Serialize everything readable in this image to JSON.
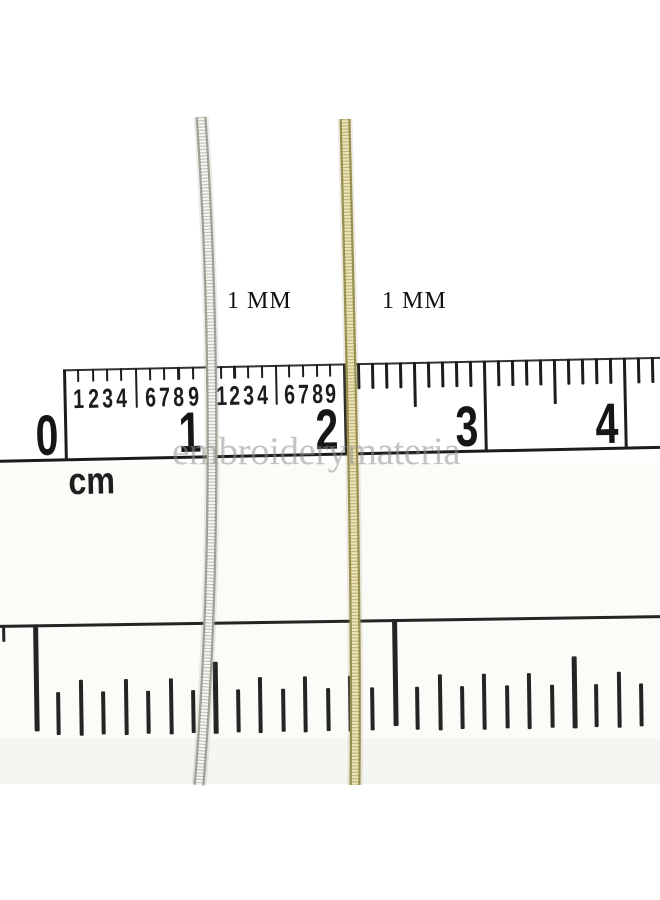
{
  "photo": {
    "background": "#ffffff",
    "bands": [
      {
        "name": "mid-tone-band",
        "top": 463,
        "height": 275,
        "color": "#fbfbf8"
      },
      {
        "name": "lower-tone-band",
        "top": 738,
        "height": 46,
        "color": "#f5f5f1"
      }
    ],
    "watermark": {
      "text": "embroiderymateria",
      "x": 172,
      "y": 429,
      "color": "#8f8f8f"
    },
    "size_labels": [
      {
        "text": "1 MM",
        "x": 227,
        "y": 288
      },
      {
        "text": "1 MM",
        "x": 382,
        "y": 288
      }
    ]
  },
  "top_ruler": {
    "unit_label": "cm",
    "ink": "#1c1c1c",
    "tilt_deg": -1.2,
    "origin": {
      "left": -15,
      "top": 371,
      "width": 700,
      "height": 140
    },
    "baseline_y": 89,
    "cm_marks": [
      {
        "label": "0",
        "x": 78
      },
      {
        "label": "1",
        "x": 221
      },
      {
        "label": "2",
        "x": 358
      },
      {
        "label": "3",
        "x": 498
      },
      {
        "label": "4",
        "x": 638
      }
    ],
    "mm_digit_run": [
      "1",
      "2",
      "3",
      "4",
      "6",
      "7",
      "8",
      "9"
    ],
    "digit_sections": [
      0,
      1
    ],
    "plain_sections": [
      2,
      3,
      4
    ],
    "tick_style": {
      "fine": {
        "len": 13,
        "long5": 40,
        "w": 2.2
      },
      "plain": {
        "len": 26,
        "long5": 45,
        "w": 3.4
      }
    }
  },
  "bottom_ruler": {
    "ink": "#242424",
    "tilt_deg": -0.85,
    "origin": {
      "left": -5,
      "top": 619,
      "width": 700,
      "height": 170
    },
    "topline_y": 6,
    "end_stub_x": 7,
    "ticks": {
      "major_x": [
        38,
        397
      ],
      "half_x": [
        217,
        576
      ],
      "eighth_x": [
        83,
        128,
        173,
        262,
        307,
        352,
        442,
        486,
        531,
        621,
        665
      ],
      "sixteenth_x": [
        60,
        105,
        150,
        195,
        240,
        285,
        330,
        374,
        419,
        464,
        509,
        554,
        598,
        643
      ]
    },
    "tick_style": {
      "major": {
        "top": 6,
        "len": 107,
        "w": 5
      },
      "half": {
        "top": 46,
        "len": 72,
        "w": 4.5
      },
      "eighth": {
        "top": 62,
        "len": 56,
        "w": 4
      },
      "sixteenth": {
        "top": 74,
        "len": 43,
        "w": 4
      }
    }
  },
  "threads": [
    {
      "name": "silver-thread",
      "size_label": "1 MM",
      "path": "M 201,117 C 214,300 218,560 199,785",
      "halo": "rgba(150,150,140,0.18)",
      "outer": "#a3a399",
      "inner": "#f7f7f2",
      "ridge": "rgba(80,80,72,0.30)"
    },
    {
      "name": "gold-thread",
      "size_label": "1 MM",
      "path": "M 345,119 C 350,320 357,580 355,785",
      "halo": "rgba(160,150,100,0.18)",
      "outer": "#9b9254",
      "inner": "#ede5b4",
      "ridge": "rgba(105,95,40,0.35)"
    }
  ]
}
